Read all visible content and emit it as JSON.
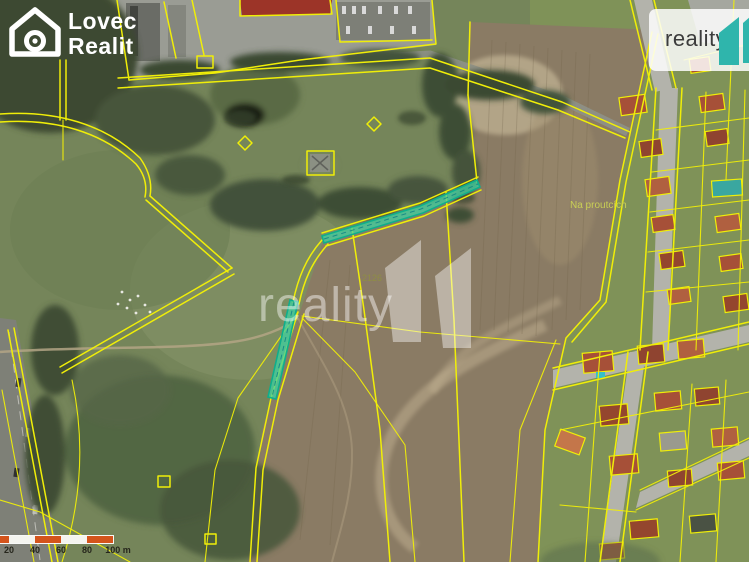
{
  "branding": {
    "map_logo": {
      "line1": "Lovec",
      "line2": "Realit"
    },
    "watermark_text": "reality",
    "corner_logo_text": "reality"
  },
  "map": {
    "labels": {
      "field_name": "Na proutcích",
      "parcel_number": "2126"
    }
  },
  "scalebar": {
    "labels": [
      "20",
      "40",
      "60",
      "80",
      "100 m"
    ]
  },
  "colors": {
    "parcel_line": "#f0ee08",
    "highlight_fill": "#3fd2a0",
    "highlight_stroke": "#0fae8c",
    "scalebar_orange": "#d4541c",
    "brand_teal": "#2fb5ac",
    "field_label": "#c9cf55"
  }
}
